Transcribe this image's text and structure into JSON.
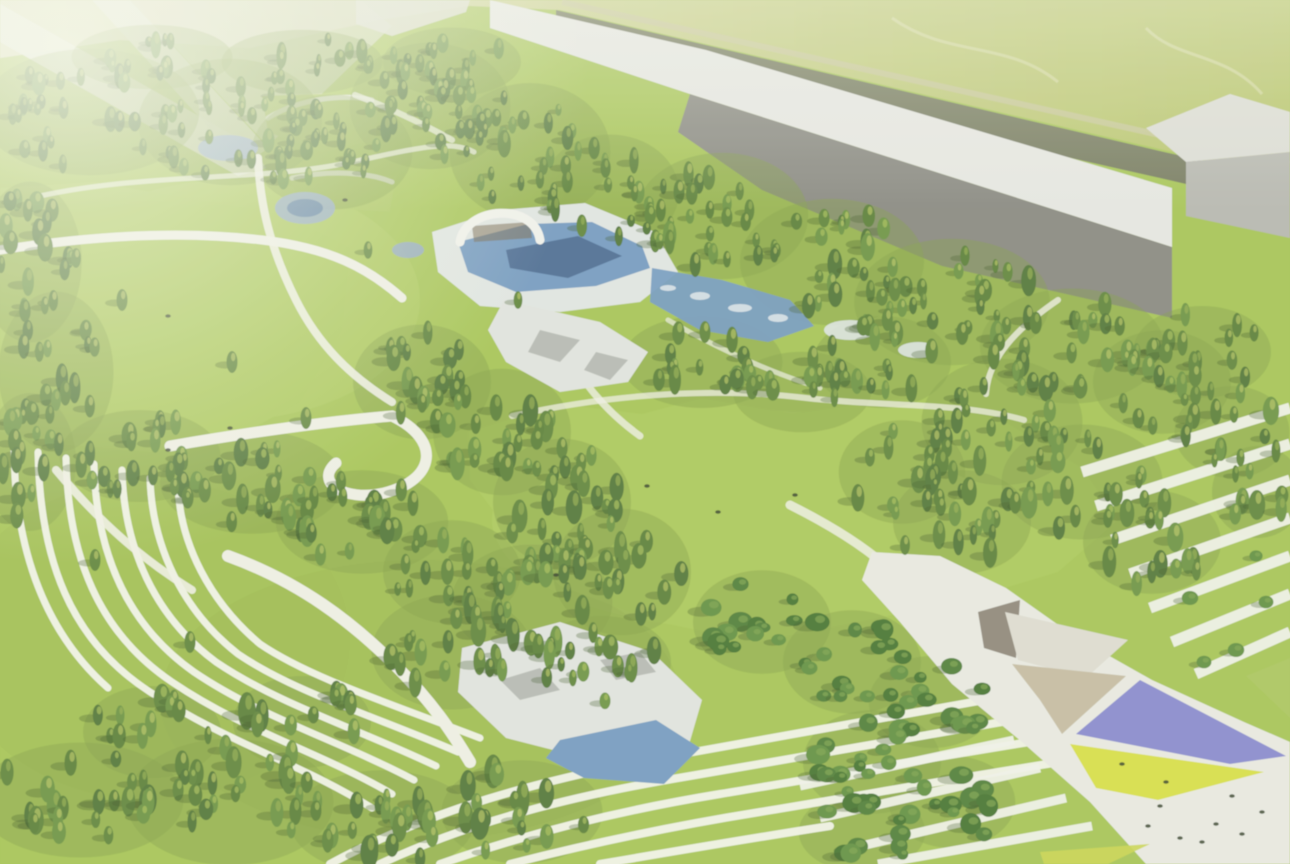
{
  "scene": {
    "description": "Aerial architectural rendering of a landscaped park masterplan: dense conifer forest bands, open lawns, curved terraced paths, central pool complex with white arch bridge, rocky pond, long grey industrial buildings along the top edge, and a white plaza with purple and yellow shade sails at bottom right. Image is hazy/washed-out toward the top-left corner.",
    "canvas": {
      "width": 1290,
      "height": 864
    },
    "palette": {
      "lawn": "#a3c24f",
      "lawn_bright": "#b2cd5f",
      "lawn_dark": "#92b046",
      "forest_floor": "#7e9c41",
      "tree_conifer": [
        "#4e7230",
        "#5b8136",
        "#68903c",
        "#567c33"
      ],
      "tree_leafy": [
        "#4c7a30",
        "#5d8c3a",
        "#417029"
      ],
      "tree_highlight": [
        "#a9c055",
        "#b9c65e",
        "#94ad4a"
      ],
      "leafy_highlight": "#79a046",
      "tree_shadow": "#36511f",
      "path": "#edeee2",
      "terrace_line": "#f1f3e8",
      "water": "#6f97bd",
      "water_dark": "#47688f",
      "water_light": "#8fa6bd",
      "deck": "#dfe4e0",
      "rock": "#dfe2dc",
      "rock_dark": "#aeb2ab",
      "building_roof": "#e4e5e0",
      "building_face": "#84847b",
      "box_top": "#d9dad2",
      "box_face": "#b3b4ac",
      "hedge": "#6a6e59",
      "road_line": "#c6c497",
      "plaza": "#e7e8df",
      "canopy_dark": "#8b8375",
      "canopy_light": "#dcdacd",
      "canopy_tan": "#c3b99e",
      "purple_sail": "#8486cb",
      "yellow_sail": "#d5dd40",
      "people": "#2e3a22",
      "field_stops": [
        "#dadcb6",
        "#ccd193",
        "#bcc773",
        "#b2c061"
      ],
      "haze": "#f8faee"
    },
    "field": {
      "poly": "0,0 1290,0 1290,178 1164,150 706,44 560,10 470,6 380,20 250,48 120,40 0,58",
      "tracks": [
        "M892,18 C948,58 1006,40 1058,82",
        "M1146,28 C1176,60 1226,52 1262,94"
      ]
    },
    "roads_topleft": [
      {
        "poly": "0,4 252,146 266,168 238,176 0,42",
        "fill": "#e4e6d6",
        "op": 0.95
      },
      {
        "poly": "92,0 130,0 268,148 244,166",
        "fill": "#dde0ce",
        "op": 0.9
      },
      {
        "poly": "130,0 360,0 392,26 268,146",
        "fill": "#d3d7bb",
        "op": 0.75
      }
    ],
    "hedge": {
      "poly": "556,10 1164,152 1290,180 1290,208 1160,178 556,42",
      "road_line": "M562,2 L1290,164"
    },
    "buildings": {
      "long_roof": "490,0 706,50 1172,188 1172,247 690,94 490,28",
      "long_face": "690,94 1172,247 1172,318 942,266 762,190 678,132",
      "box_top": "1146,128 1230,94 1290,112 1290,152 1186,162",
      "box_face": "1186,162 1290,152 1290,238 1186,216",
      "end_wall": "356,0 470,0 466,12 392,36 356,24"
    },
    "clearings": [
      {
        "poly": "262,96 378,92 376,140 322,152 268,132",
        "wall": "M268,118 C300,98 344,94 372,100"
      },
      {
        "poly": "286,166 396,176 390,212 300,206",
        "wall": "M292,178 C330,170 368,172 392,182"
      }
    ],
    "lawns": [
      {
        "poly": "0,188 95,182 185,198 282,214 350,248 342,330 300,402 232,440 150,452 58,444 0,432"
      },
      {
        "poly": "468,432 560,404 642,414 702,398 792,414 902,398 1002,420 1082,468 1118,520 1058,572 958,602 858,622 756,642 658,622 560,586 508,530 470,480"
      }
    ],
    "lawn_patches": [
      {
        "cx": 752,
        "cy": 520,
        "rx": 260,
        "ry": 110,
        "fill": "#b0cc5e",
        "op": 0.5
      },
      {
        "cx": 230,
        "cy": 300,
        "rx": 190,
        "ry": 120,
        "fill": "#b2cd60",
        "op": 0.45
      },
      {
        "cx": 420,
        "cy": 700,
        "rx": 260,
        "ry": 140,
        "fill": "#92b046",
        "op": 0.35
      },
      {
        "cx": 150,
        "cy": 640,
        "rx": 200,
        "ry": 160,
        "fill": "#97b54a",
        "op": 0.3
      }
    ],
    "terrace_fan": [
      "M14,446 C14,540 40,628 108,688",
      "M38,452 C40,560 70,640 150,692 C230,744 302,764 372,808",
      "M66,458 C68,556 98,632 172,682 C246,732 320,752 392,794",
      "M94,464 C96,552 126,624 194,672 C262,718 338,740 414,780",
      "M122,470 C124,548 154,616 216,662 C278,704 356,728 436,766",
      "M150,478 C152,546 182,610 238,654 C294,692 374,716 458,752",
      "M178,486 C180,544 210,602 260,644 C310,678 392,704 480,738"
    ],
    "terrace_bottom": [
      "M330,864 C430,810 540,780 660,758 C780,736 900,714 1040,690",
      "M380,864 C470,822 570,796 690,776 C810,756 930,734 1060,712",
      "M440,864 C520,836 610,812 720,794 C830,776 950,754 1080,734",
      "M510,864 C580,846 660,828 760,812 C870,794 990,772 1100,756",
      "M600,864 C670,852 740,840 830,826"
    ],
    "stripes_right": [
      "M1082,472 L1290,408",
      "M1096,506 L1290,444",
      "M1112,540 L1290,480",
      "M1130,574 L1290,518",
      "M1150,608 L1290,556",
      "M1172,642 L1290,594",
      "M1196,674 L1290,632"
    ],
    "stripes_bottom_right": [
      "M800,786 L1014,740",
      "M820,818 L1040,768",
      "M844,850 L1066,798",
      "M878,864 L1092,826"
    ],
    "paths": [
      {
        "d": "M0,250 C90,236 180,230 262,240 C330,248 368,268 402,298",
        "w": 9,
        "op": 1
      },
      {
        "d": "M258,158 C260,205 270,248 296,300 C318,344 350,376 392,402",
        "w": 8,
        "op": 0.9
      },
      {
        "d": "M40,196 C150,172 260,182 352,162 C420,147 452,140 474,152",
        "w": 5,
        "op": 0.7
      },
      {
        "d": "M170,446 C252,432 332,421 392,416 C442,440 436,480 384,493 C344,502 314,482 336,463",
        "w": 11,
        "op": 1
      },
      {
        "d": "M512,416 C620,392 724,388 806,398 C884,407 962,402 1024,420",
        "w": 6,
        "op": 0.75
      },
      {
        "d": "M1058,300 C1014,330 988,360 986,394",
        "w": 6,
        "op": 0.8
      },
      {
        "d": "M228,556 C300,582 352,622 396,666 C432,702 452,732 470,762",
        "w": 12,
        "op": 1
      },
      {
        "d": "M56,470 C98,520 140,558 192,590",
        "w": 8,
        "op": 0.9
      },
      {
        "d": "M560,340 C580,380 604,410 640,436",
        "w": 7,
        "op": 0.8
      },
      {
        "d": "M790,505 C830,525 862,545 886,566",
        "w": 9,
        "op": 0.85
      },
      {
        "d": "M355,95 C390,108 420,122 452,140",
        "w": 6,
        "op": 0.7
      },
      {
        "d": "M668,320 C720,350 770,372 820,388",
        "w": 5,
        "op": 0.7
      }
    ],
    "water": {
      "deck": "432,232 500,210 585,203 655,232 678,272 640,302 560,312 480,306 438,272",
      "pool": "458,242 528,224 592,222 642,246 650,268 596,286 516,292 468,272",
      "pool_inner": "506,250 578,236 622,256 568,278 510,268",
      "east_pool": "652,268 722,280 790,300 814,326 768,342 700,330 650,302",
      "flecks": [
        [
          700,
          296,
          10,
          4
        ],
        [
          740,
          308,
          12,
          4
        ],
        [
          668,
          288,
          8,
          3
        ],
        [
          778,
          318,
          10,
          4
        ],
        [
          850,
          330,
          26,
          10
        ],
        [
          918,
          350,
          20,
          8
        ]
      ],
      "rocky_mid": "504,300 600,322 648,352 628,382 560,392 506,362 488,330",
      "rocky_mid_patches": [
        "540,330 580,340 560,362 528,352",
        "596,352 628,360 610,380 584,370"
      ],
      "rocky_pond": "462,648 560,622 652,652 702,700 688,748 600,762 506,738 458,692",
      "pond": "560,740 656,720 700,748 664,784 584,778 546,758",
      "rocky_pond_patches": [
        "500,680 540,668 560,690 520,700",
        "600,660 640,652 656,672 616,680"
      ],
      "small_ponds": [
        [
          228,
          148,
          30,
          13
        ],
        [
          305,
          208,
          30,
          16
        ],
        [
          408,
          250,
          16,
          8
        ]
      ],
      "small_pond_inner": [
        [
          305,
          208,
          18,
          9
        ]
      ]
    },
    "arch": {
      "shade": "472,226 530,222 532,238 474,242",
      "outer": "M460,242 C466,206 534,202 540,240"
    },
    "plaza": {
      "base": "872,552 940,556 1006,588 1074,636 1152,680 1244,722 1290,742 1290,864 1146,864 1090,802 1022,742 952,684 900,622 862,580",
      "canopies": [
        {
          "poly": "978,612 1020,600 1016,658 984,648",
          "fill": "#8b8375"
        },
        {
          "poly": "1005,612 1128,640 1086,678 1018,660",
          "fill": "#dcdacd"
        },
        {
          "poly": "1012,664 1126,676 1062,734 1040,700",
          "fill": "#c3b99e"
        }
      ],
      "purple_sail": "1076,734 1140,680 1286,756 1230,764",
      "yellow_sail": "1070,744 1264,772 1158,800 1096,788",
      "green_wedge": "1246,676 1290,658 1290,718",
      "corner_tri": "1040,852 1150,844 1108,864 1044,864",
      "dots": [
        [
          1160,
          806
        ],
        [
          1216,
          824
        ],
        [
          1232,
          796
        ],
        [
          1180,
          838
        ],
        [
          1202,
          842
        ],
        [
          1166,
          782
        ],
        [
          1242,
          834
        ],
        [
          1122,
          764
        ],
        [
          1262,
          812
        ],
        [
          1148,
          826
        ]
      ]
    },
    "people": [
      [
        647,
        486
      ],
      [
        718,
        512
      ],
      [
        795,
        495
      ],
      [
        168,
        316
      ],
      [
        230,
        428
      ],
      [
        168,
        450
      ],
      [
        556,
        575
      ],
      [
        345,
        200
      ]
    ],
    "tree_regions": [
      {
        "name": "top-band",
        "type": "c",
        "size": 0.85,
        "seed": 11,
        "blobs": [
          [
            90,
            112,
            95,
            55,
            30
          ],
          [
            230,
            122,
            80,
            55,
            26
          ],
          [
            332,
            152,
            70,
            50,
            22
          ],
          [
            430,
            106,
            70,
            55,
            26
          ],
          [
            530,
            152,
            70,
            60,
            26
          ],
          [
            610,
            192,
            60,
            50,
            19
          ],
          [
            452,
            62,
            60,
            30,
            13
          ],
          [
            302,
            62,
            70,
            28,
            13
          ],
          [
            152,
            57,
            70,
            28,
            11
          ]
        ]
      },
      {
        "name": "under-building",
        "type": "c",
        "size": 0.95,
        "seed": 22,
        "blobs": [
          [
            722,
            216,
            75,
            55,
            26
          ],
          [
            832,
            262,
            80,
            55,
            26
          ],
          [
            952,
            302,
            85,
            55,
            26
          ],
          [
            1072,
            346,
            80,
            50,
            22
          ],
          [
            1162,
            382,
            60,
            45,
            15
          ],
          [
            702,
            362,
            70,
            40,
            16
          ],
          [
            802,
            392,
            60,
            35,
            13
          ],
          [
            882,
            362,
            60,
            40,
            13
          ]
        ]
      },
      {
        "name": "left-edge",
        "type": "c",
        "size": 1.0,
        "seed": 33,
        "blobs": [
          [
            30,
            262,
            45,
            70,
            19
          ],
          [
            56,
            372,
            50,
            70,
            19
          ],
          [
            30,
            462,
            40,
            60,
            13
          ]
        ]
      },
      {
        "name": "mid-diagonal",
        "type": "c",
        "size": 1.0,
        "seed": 44,
        "blobs": [
          [
            140,
            456,
            70,
            40,
            19
          ],
          [
            252,
            482,
            80,
            45,
            22
          ],
          [
            362,
            522,
            75,
            45,
            21
          ],
          [
            452,
            572,
            60,
            45,
            16
          ]
        ]
      },
      {
        "name": "center-cluster",
        "type": "c",
        "size": 1.05,
        "seed": 55,
        "blobs": [
          [
            422,
            382,
            60,
            50,
            21
          ],
          [
            502,
            432,
            60,
            55,
            21
          ],
          [
            562,
            502,
            60,
            55,
            21
          ],
          [
            622,
            572,
            60,
            55,
            19
          ],
          [
            532,
            602,
            70,
            50,
            21
          ],
          [
            452,
            652,
            70,
            50,
            19
          ],
          [
            602,
            662,
            60,
            40,
            15
          ]
        ]
      },
      {
        "name": "bottom-band",
        "type": "c",
        "size": 1.15,
        "seed": 66,
        "blobs": [
          [
            80,
            800,
            90,
            50,
            22
          ],
          [
            230,
            802,
            90,
            55,
            24
          ],
          [
            382,
            822,
            80,
            45,
            19
          ],
          [
            522,
            812,
            70,
            45,
            16
          ],
          [
            302,
            722,
            60,
            40,
            13
          ],
          [
            152,
            732,
            60,
            40,
            13
          ]
        ]
      },
      {
        "name": "right-mid",
        "type": "c",
        "size": 1.0,
        "seed": 77,
        "blobs": [
          [
            1002,
            422,
            70,
            55,
            21
          ],
          [
            1082,
            482,
            70,
            50,
            19
          ],
          [
            1152,
            542,
            60,
            45,
            16
          ],
          [
            962,
            522,
            60,
            45,
            16
          ],
          [
            902,
            472,
            55,
            45,
            15
          ],
          [
            1232,
            432,
            50,
            40,
            12
          ],
          [
            1202,
            352,
            60,
            40,
            13
          ],
          [
            1258,
            492,
            40,
            40,
            10
          ]
        ]
      },
      {
        "name": "east-clumps",
        "type": "l",
        "size": 1.1,
        "seed": 88,
        "blobs": [
          [
            762,
            622,
            60,
            45,
            16
          ],
          [
            852,
            662,
            60,
            45,
            16
          ],
          [
            932,
            702,
            55,
            40,
            13
          ],
          [
            872,
            762,
            60,
            45,
            15
          ],
          [
            952,
            802,
            55,
            40,
            13
          ],
          [
            862,
            832,
            55,
            35,
            12
          ]
        ]
      }
    ],
    "single_trees": [
      [
        76,
        258,
        0.9,
        "c"
      ],
      [
        122,
        300,
        1,
        "c"
      ],
      [
        232,
        362,
        1,
        "c"
      ],
      [
        306,
        418,
        1,
        "c"
      ],
      [
        160,
        420,
        0.9,
        "c"
      ],
      [
        562,
        448,
        1,
        "c"
      ],
      [
        95,
        560,
        1,
        "c"
      ],
      [
        190,
        642,
        1,
        "c"
      ],
      [
        905,
        545,
        0.9,
        "c"
      ],
      [
        705,
        332,
        1,
        "c"
      ],
      [
        518,
        300,
        0.8,
        "c"
      ],
      [
        368,
        250,
        0.8,
        "c"
      ],
      [
        1190,
        598,
        1,
        "l"
      ],
      [
        1236,
        650,
        1,
        "l"
      ],
      [
        1266,
        602,
        0.9,
        "l"
      ],
      [
        1204,
        662,
        0.9,
        "l"
      ],
      [
        1256,
        556,
        0.8,
        "l"
      ]
    ],
    "haze": {
      "glare": {
        "cx": 70,
        "cy": 45,
        "r": 520,
        "op": 0.72
      },
      "top_band": {
        "h": 210,
        "op": 0.38
      },
      "veil_op": 0.12,
      "blur": 0.55
    }
  }
}
